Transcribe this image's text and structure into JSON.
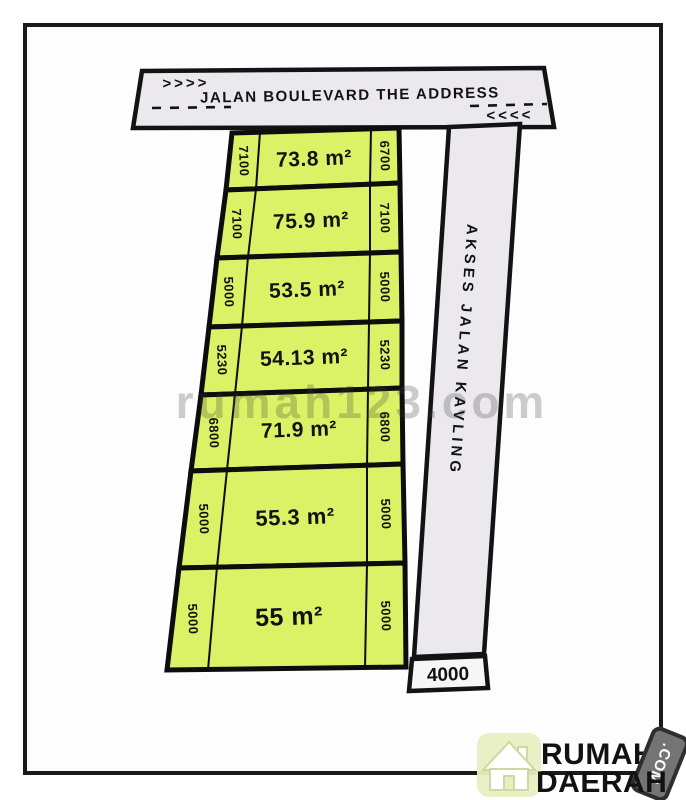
{
  "top_road": {
    "name": "JALAN BOULEVARD THE ADDRESS",
    "arrows_left": ">>>>",
    "arrows_right": "<<<<"
  },
  "access_road": {
    "name": "AKSES JALAN KAVLING",
    "width_label": "4000"
  },
  "plots": [
    {
      "area": "73.8 m²",
      "left": "7100",
      "right": "6700"
    },
    {
      "area": "75.9 m²",
      "left": "7100",
      "right": "7100"
    },
    {
      "area": "53.5 m²",
      "left": "5000",
      "right": "5000"
    },
    {
      "area": "54.13 m²",
      "left": "5230",
      "right": "5230"
    },
    {
      "area": "71.9 m²",
      "left": "6800",
      "right": "6800"
    },
    {
      "area": "55.3 m²",
      "left": "5000",
      "right": "5000"
    },
    {
      "area": "55 m²",
      "left": "5000",
      "right": "5000"
    }
  ],
  "watermark": "rumah123.com",
  "logo": {
    "line1": "RUMAH",
    "line2": "DAERAH",
    "badge": ".COM"
  },
  "colors": {
    "plot_fill": "#dbf266",
    "road_fill": "#ebe9ed",
    "box_fill": "#f6f5f7",
    "line": "#131313",
    "logo_blue": "#3fa8e2",
    "logo_orange": "#ee7326",
    "badge_gray": "#747474",
    "badge_edge": "#2e2e2e",
    "house_bg": "#e9efc3"
  }
}
